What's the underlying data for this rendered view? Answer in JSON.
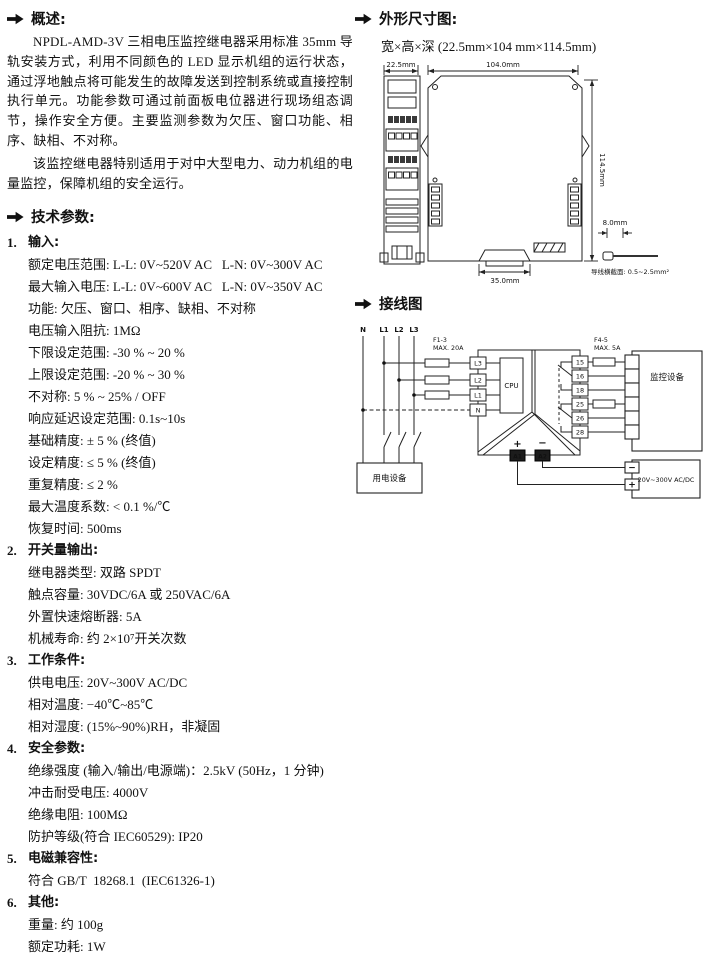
{
  "overview": {
    "title": "概述:",
    "para1": "NPDL-AMD-3V 三相电压监控继电器采用标准 35mm 导轨安装方式，利用不同颜色的 LED 显示机组的运行状态，通过浮地触点将可能发生的故障发送到控制系统或直接控制执行单元。功能参数可通过前面板电位器进行现场组态调节，操作安全方便。主要监测参数为欠压、窗口功能、相序、缺相、不对称。",
    "para2": "该监控继电器特别适用于对中大型电力、动力机组的电量监控，保障机组的安全运行。"
  },
  "tech": {
    "title": "技术参数:",
    "sections": [
      {
        "num": "1.",
        "title": "输入:",
        "items": [
          "额定电压范围: L-L: 0V~520V AC   L-N: 0V~300V AC",
          "最大输入电压: L-L: 0V~600V AC   L-N: 0V~350V AC",
          "功能: 欠压、窗口、相序、缺相、不对称",
          "电压输入阻抗: 1MΩ",
          "下限设定范围: -30 % ~ 20 %",
          "上限设定范围: -20 % ~ 30 %",
          "不对称: 5 % ~ 25% / OFF",
          "响应延迟设定范围: 0.1s~10s",
          "基础精度: ± 5 % (终值)",
          "设定精度: ≤ 5 % (终值)",
          "重复精度: ≤ 2 %",
          "最大温度系数: < 0.1 %/℃",
          "恢复时间: 500ms"
        ]
      },
      {
        "num": "2.",
        "title": "开关量输出:",
        "items": [
          "继电器类型: 双路 SPDT",
          "触点容量: 30VDC/6A 或 250VAC/6A",
          "外置快速熔断器: 5A",
          "机械寿命: 约 2×10⁷开关次数"
        ]
      },
      {
        "num": "3.",
        "title": "工作条件:",
        "items": [
          "供电电压: 20V~300V AC/DC",
          "相对温度: −40℃~85℃",
          "相对湿度: (15%~90%)RH，非凝固"
        ]
      },
      {
        "num": "4.",
        "title": "安全参数:",
        "items": [
          "绝缘强度 (输入/输出/电源端)：2.5kV (50Hz，1 分钟)",
          "冲击耐受电压: 4000V",
          "绝缘电阻: 100MΩ",
          "防护等级(符合 IEC60529): IP20"
        ]
      },
      {
        "num": "5.",
        "title": "电磁兼容性:",
        "items": [
          "符合 GB/T  18268.1  (IEC61326-1)"
        ]
      },
      {
        "num": "6.",
        "title": "其他:",
        "items": [
          "重量: 约 100g",
          "额定功耗: 1W"
        ]
      }
    ]
  },
  "dimensions": {
    "title": "外形尺寸图:",
    "subtitle": "宽×高×深 (22.5mm×104 mm×114.5mm)",
    "width_label": "22.5mm",
    "length_label": "104.0mm",
    "height_label": "114.5mm",
    "rail_label": "35.0mm",
    "wire_dia_label": "8.0mm",
    "wire_note": "导线横截面: 0.5~2.5mm²"
  },
  "wiring": {
    "title": "接线图",
    "phases": [
      "N",
      "L1",
      "L2",
      "L3"
    ],
    "fuse_input_label": "F1-3",
    "fuse_input_rating": "MAX. 20A",
    "input_terminals": [
      "L3",
      "L2",
      "L1",
      "N"
    ],
    "cpu_label": "CPU",
    "fuse_output_label": "F4-5",
    "fuse_output_rating": "MAX. 5A",
    "output_terminals": [
      "15",
      "16",
      "18",
      "25",
      "26",
      "28"
    ],
    "monitor_label": "监控设备",
    "load_label": "用电设备",
    "power_label": "20V~300V AC/DC",
    "plus": "+",
    "minus": "−",
    "a1_label": "A1",
    "a2_label": "A2",
    "power_minus": "−",
    "power_plus": "+"
  }
}
